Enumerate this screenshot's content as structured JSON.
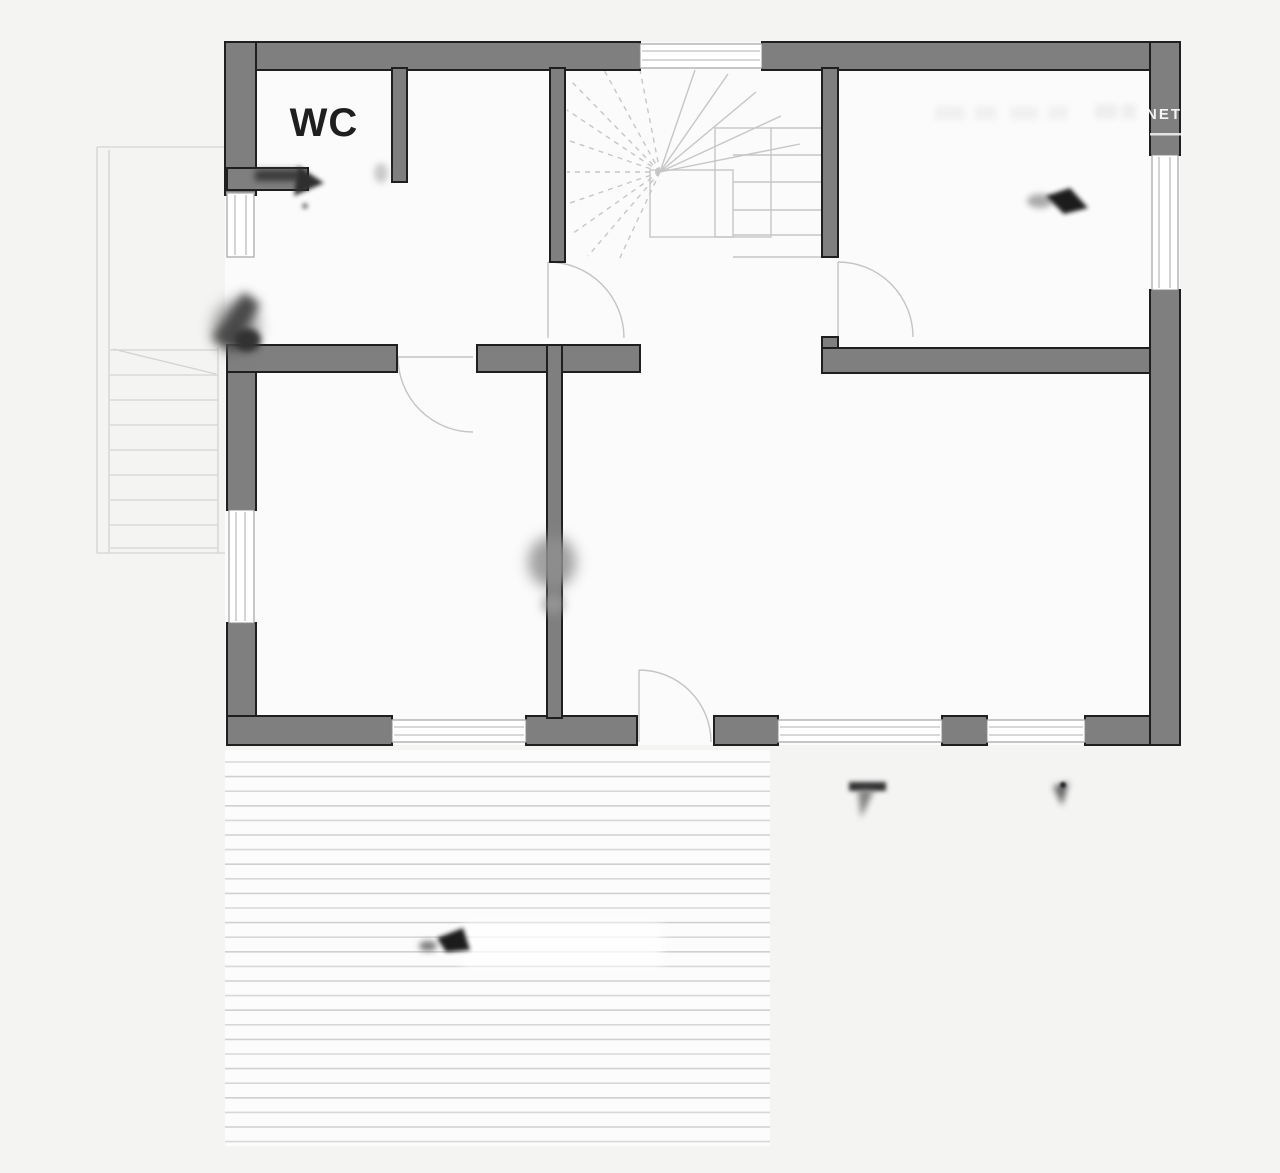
{
  "plan": {
    "room_label_wc": "WC",
    "watermark_text": "NET"
  },
  "colors": {
    "background": "#f4f4f3",
    "room_fill": "#fbfbfb",
    "terrace_fill": "#fcfcfc",
    "wall_fill": "#7f7f7f",
    "wall_outline": "#1f1f1f",
    "thin_line": "#c6c6c6",
    "window_frame": "#b0b0b0",
    "terrace_line": "#d8d8d8",
    "label_text": "#1f1f1f"
  },
  "terrace": {
    "line_count": 27,
    "spacing": 14.6,
    "x_start": 225,
    "x_end": 770,
    "y_start": 762
  },
  "features": [
    "winder-staircase",
    "entry-porch-steps",
    "terrace-decking",
    "interior-door-swings",
    "erased-annotation-smudges"
  ]
}
